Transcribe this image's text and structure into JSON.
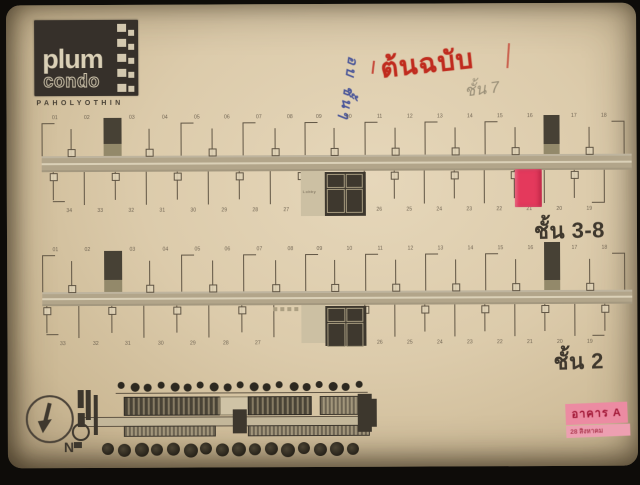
{
  "logo": {
    "name": "plum",
    "type": "condo",
    "brand": "PAHOLYOTHIN"
  },
  "stamp": {
    "text": "ต้นฉบับ"
  },
  "notes": {
    "pencil": "ชั้น 7",
    "pen_blue": "อบ ชั้นๆ"
  },
  "strips": [
    {
      "label": "ชั้น 3-8",
      "top_units": [
        "01",
        "02",
        "03",
        "04",
        "05",
        "06",
        "07",
        "08",
        "09",
        "10",
        "11",
        "12",
        "13",
        "14",
        "15",
        "16",
        "17",
        "18"
      ],
      "bottom_units_left": [
        "34",
        "33",
        "32",
        "31",
        "30",
        "29",
        "28",
        "27"
      ],
      "bottom_units_right": [
        "26",
        "25",
        "24",
        "23",
        "22",
        "21",
        "20",
        "19"
      ],
      "core_label": "Lobby",
      "highlight_unit": "21"
    },
    {
      "label": "ชั้น 2",
      "top_units": [
        "01",
        "02",
        "03",
        "04",
        "05",
        "06",
        "07",
        "08",
        "09",
        "10",
        "11",
        "12",
        "13",
        "14",
        "15",
        "16",
        "17",
        "18"
      ],
      "bottom_units_left": [
        "33",
        "32",
        "31",
        "30",
        "29",
        "28",
        "27"
      ],
      "bottom_units_right": [
        "26",
        "25",
        "24",
        "23",
        "22",
        "21",
        "20",
        "19"
      ],
      "core_label": "",
      "highlight_unit": null
    }
  ],
  "compass": {
    "label": "N"
  },
  "building_label": {
    "line1": "อาคาร A",
    "line2": "28 สิงหาคม"
  },
  "colors": {
    "highlight_pink": "#e8365b",
    "stamp_red": "#c3271a",
    "pen_blue": "#2c3e96",
    "label_pink": "#f08ba3",
    "label_text": "#a21232"
  },
  "site_plan": {
    "top_trees": 19,
    "bottom_trees": 16
  }
}
